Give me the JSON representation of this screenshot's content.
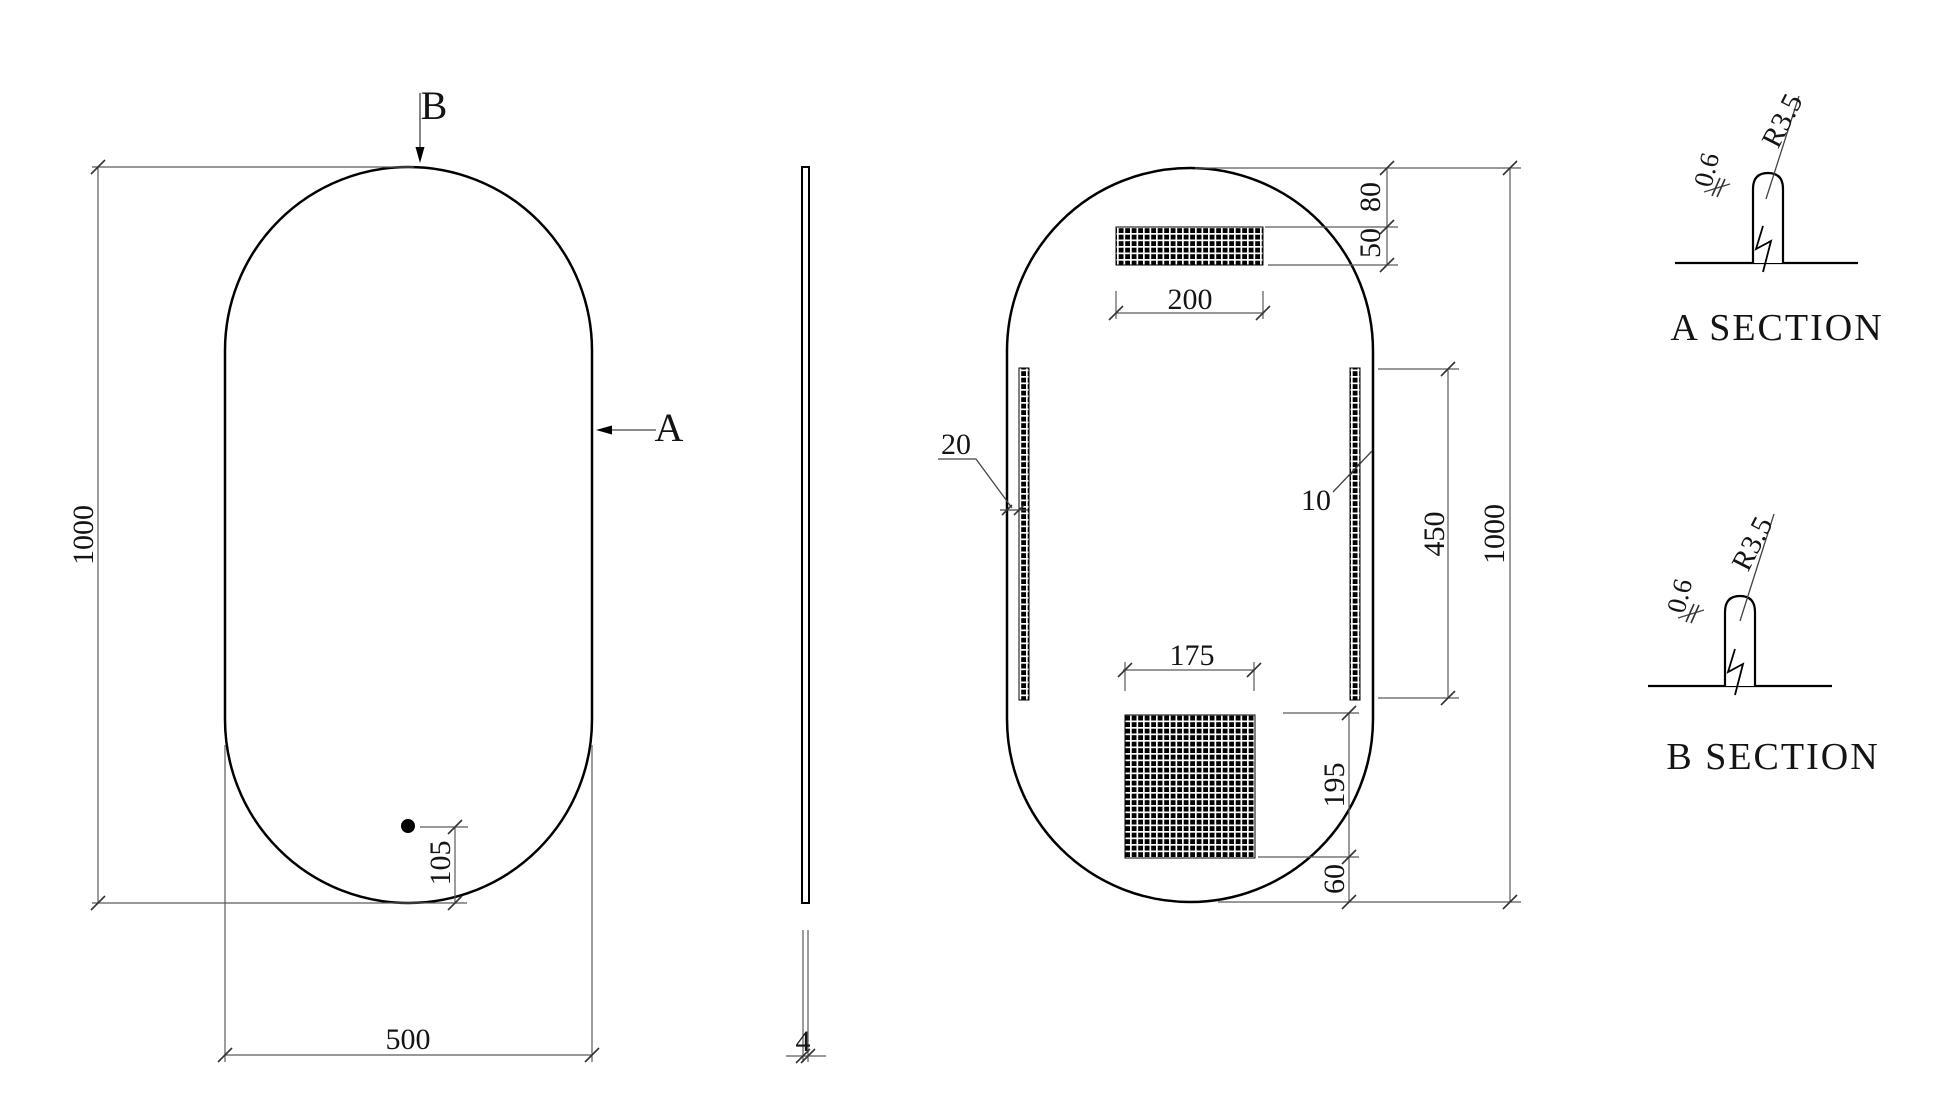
{
  "drawing": {
    "front_view": {
      "label_b": "B",
      "label_a": "A",
      "dim_height": "1000",
      "dim_width": "500",
      "dim_sensor_offset": "105"
    },
    "side_view": {
      "dim_thickness": "4"
    },
    "back_view": {
      "dim_top_offset": "80",
      "dim_top_pad_height": "50",
      "dim_top_pad_width": "200",
      "dim_edge_gap": "20",
      "dim_strip_width": "10",
      "dim_strip_length": "450",
      "dim_height": "1000",
      "dim_bottom_pad_width": "175",
      "dim_bottom_pad_height": "195",
      "dim_bottom_offset": "60"
    },
    "section_a": {
      "title": "A SECTION",
      "dim_radius": "R3.5",
      "dim_depth": "0.6"
    },
    "section_b": {
      "title": "B SECTION",
      "dim_radius": "R3.5",
      "dim_depth": "0.6"
    }
  }
}
